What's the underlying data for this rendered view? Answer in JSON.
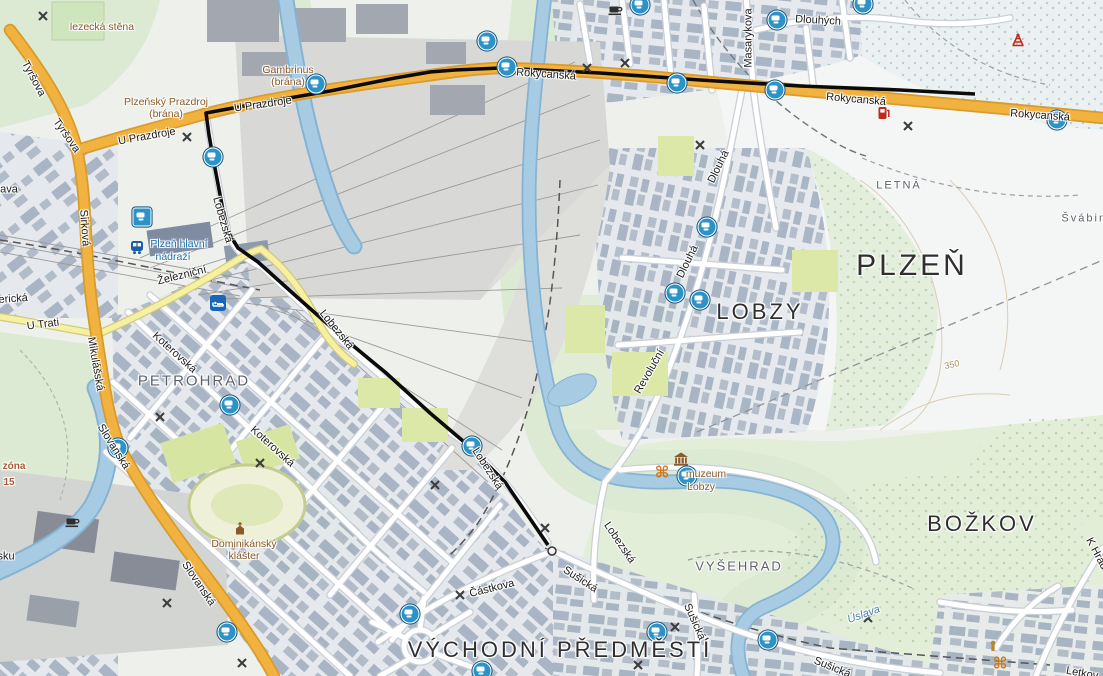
{
  "map": {
    "route": {
      "color": "#0b0b0b",
      "points": [
        [
          975,
          94
        ],
        [
          900,
          90
        ],
        [
          800,
          86
        ],
        [
          700,
          80
        ],
        [
          600,
          73
        ],
        [
          540,
          70
        ],
        [
          500,
          68
        ],
        [
          455,
          70
        ],
        [
          430,
          72
        ],
        [
          395,
          78
        ],
        [
          330,
          91
        ],
        [
          260,
          103
        ],
        [
          206,
          113
        ],
        [
          209,
          135
        ],
        [
          214,
          163
        ],
        [
          222,
          205
        ],
        [
          228,
          232
        ],
        [
          238,
          248
        ],
        [
          258,
          262
        ],
        [
          297,
          297
        ],
        [
          340,
          335
        ],
        [
          385,
          372
        ],
        [
          430,
          413
        ],
        [
          470,
          447
        ],
        [
          505,
          482
        ],
        [
          548,
          545
        ]
      ],
      "end_dot": [
        552,
        551
      ]
    },
    "labels": [
      {
        "text": "PLZEŇ",
        "x": 912,
        "y": 266,
        "r": 0,
        "c": "d1",
        "s": 30
      },
      {
        "text": "LOBZY",
        "x": 760,
        "y": 312,
        "r": 0,
        "c": "d1",
        "s": 22
      },
      {
        "text": "BOŽKOV",
        "x": 982,
        "y": 524,
        "r": 0,
        "c": "d1",
        "s": 22
      },
      {
        "text": "VÝCHODNÍ PŘEDMĚSTÍ",
        "x": 560,
        "y": 650,
        "r": 0,
        "c": "d1",
        "s": 22
      },
      {
        "text": "PETROHRAD",
        "x": 194,
        "y": 381,
        "r": 0,
        "c": "d2",
        "s": 15
      },
      {
        "text": "VYŠEHRAD",
        "x": 739,
        "y": 566,
        "r": 0,
        "c": "d2",
        "s": 13
      },
      {
        "text": "LETNÁ",
        "x": 899,
        "y": 186,
        "r": 0,
        "c": "d2",
        "s": 11
      },
      {
        "text": "Švábiny",
        "x": 1088,
        "y": 219,
        "r": 0,
        "c": "d2",
        "s": 11
      },
      {
        "text": "Tyršova",
        "x": 33,
        "y": 79,
        "r": 62,
        "c": "st"
      },
      {
        "text": "Tyršova",
        "x": 66,
        "y": 136,
        "r": 55,
        "c": "st"
      },
      {
        "text": "Sirková",
        "x": 84,
        "y": 228,
        "r": 86,
        "c": "st"
      },
      {
        "text": "U Prazdroje",
        "x": 263,
        "y": 105,
        "r": -8,
        "c": "st"
      },
      {
        "text": "U Prazdroje",
        "x": 147,
        "y": 137,
        "r": -10,
        "c": "st"
      },
      {
        "text": "Rokycanská",
        "x": 546,
        "y": 75,
        "r": 4,
        "c": "st"
      },
      {
        "text": "Rokycanská",
        "x": 856,
        "y": 100,
        "r": 5,
        "c": "st"
      },
      {
        "text": "Rokycanská",
        "x": 1040,
        "y": 116,
        "r": 4,
        "c": "st"
      },
      {
        "text": "Masarykova",
        "x": 749,
        "y": 38,
        "r": -90,
        "c": "st"
      },
      {
        "text": "Dlouhých",
        "x": 818,
        "y": 21,
        "r": 3,
        "c": "st"
      },
      {
        "text": "Dlouhá",
        "x": 719,
        "y": 167,
        "r": -64,
        "c": "st"
      },
      {
        "text": "Dlouhá",
        "x": 688,
        "y": 262,
        "r": -64,
        "c": "st"
      },
      {
        "text": "Revoluční",
        "x": 650,
        "y": 372,
        "r": -60,
        "c": "st"
      },
      {
        "text": "Lobezská",
        "x": 222,
        "y": 220,
        "r": 74,
        "c": "st"
      },
      {
        "text": "Lobezská",
        "x": 336,
        "y": 330,
        "r": 51,
        "c": "st"
      },
      {
        "text": "Lobezská",
        "x": 487,
        "y": 469,
        "r": 57,
        "c": "st"
      },
      {
        "text": "Lobezská",
        "x": 619,
        "y": 543,
        "r": 56,
        "c": "st"
      },
      {
        "text": "Železniční",
        "x": 182,
        "y": 276,
        "r": -14,
        "c": "st"
      },
      {
        "text": "U Trati",
        "x": 43,
        "y": 325,
        "r": -7,
        "c": "st"
      },
      {
        "text": "Mikulášská",
        "x": 95,
        "y": 364,
        "r": 80,
        "c": "st"
      },
      {
        "text": "Koterovská",
        "x": 174,
        "y": 353,
        "r": 42,
        "c": "st"
      },
      {
        "text": "Koterovská",
        "x": 272,
        "y": 447,
        "r": 42,
        "c": "st"
      },
      {
        "text": "Slovanská",
        "x": 113,
        "y": 447,
        "r": 58,
        "c": "st"
      },
      {
        "text": "Slovanská",
        "x": 198,
        "y": 584,
        "r": 56,
        "c": "st"
      },
      {
        "text": "Sušická",
        "x": 580,
        "y": 580,
        "r": 33,
        "c": "st"
      },
      {
        "text": "Sušická",
        "x": 694,
        "y": 622,
        "r": 66,
        "c": "st"
      },
      {
        "text": "Sušická",
        "x": 832,
        "y": 668,
        "r": 22,
        "c": "st"
      },
      {
        "text": "Částkova",
        "x": 492,
        "y": 589,
        "r": -14,
        "c": "st"
      },
      {
        "text": "K Hrádku",
        "x": 1099,
        "y": 559,
        "r": 62,
        "c": "st"
      },
      {
        "text": "Letkov",
        "x": 1082,
        "y": 674,
        "r": 10,
        "c": "st"
      },
      {
        "text": "Americká",
        "x": 5,
        "y": 300,
        "r": -4,
        "c": "st"
      },
      {
        "text": "ava",
        "x": 9,
        "y": 190,
        "r": 0,
        "c": "st"
      },
      {
        "text": "sku",
        "x": 6,
        "y": 557,
        "r": 0,
        "c": "st"
      },
      {
        "text": "lezecká stěna",
        "x": 102,
        "y": 27,
        "r": 0,
        "c": "poi"
      },
      {
        "text": "Gambrinus",
        "x": 288,
        "y": 70,
        "r": 0,
        "c": "poi"
      },
      {
        "text": "(brána)",
        "x": 288,
        "y": 82,
        "r": 0,
        "c": "poi"
      },
      {
        "text": "Plzeňský Prazdroj",
        "x": 166,
        "y": 102,
        "r": 0,
        "c": "poi"
      },
      {
        "text": "(brána)",
        "x": 166,
        "y": 114,
        "r": 0,
        "c": "poi"
      },
      {
        "text": "Dominikánský",
        "x": 244,
        "y": 544,
        "r": 0,
        "c": "poi"
      },
      {
        "text": "klášter",
        "x": 244,
        "y": 556,
        "r": 0,
        "c": "poi"
      },
      {
        "text": "muzeum",
        "x": 706,
        "y": 474,
        "r": 0,
        "c": "poi"
      },
      {
        "text": "Lobzy",
        "x": 701,
        "y": 487,
        "r": 0,
        "c": "poi"
      },
      {
        "text": "Plzeň hlavní",
        "x": 179,
        "y": 244,
        "r": 0,
        "c": "sta"
      },
      {
        "text": "nádraží",
        "x": 173,
        "y": 257,
        "r": 0,
        "c": "sta"
      },
      {
        "text": "Úslava",
        "x": 864,
        "y": 615,
        "r": -20,
        "c": "wat"
      },
      {
        "text": "zóna",
        "x": 14,
        "y": 467,
        "r": 0,
        "c": "zon"
      },
      {
        "text": "15",
        "x": 9,
        "y": 483,
        "r": 0,
        "c": "zon"
      },
      {
        "text": "350",
        "x": 952,
        "y": 365,
        "r": -12,
        "c": "con"
      }
    ],
    "tram_stops": [
      [
        487,
        41
      ],
      [
        640,
        5
      ],
      [
        316,
        84
      ],
      [
        507,
        67
      ],
      [
        677,
        83
      ],
      [
        777,
        20
      ],
      [
        863,
        4
      ],
      [
        775,
        90
      ],
      [
        1057,
        120
      ],
      [
        213,
        157
      ],
      [
        230,
        405
      ],
      [
        118,
        448
      ],
      [
        472,
        446
      ],
      [
        707,
        227
      ],
      [
        675,
        293
      ],
      [
        700,
        300
      ],
      [
        410,
        614
      ],
      [
        657,
        632
      ],
      [
        482,
        671
      ],
      [
        687,
        476
      ],
      [
        768,
        640
      ],
      [
        227,
        632
      ]
    ],
    "square_stops": [
      [
        142,
        217
      ]
    ],
    "mill_icons": [
      [
        43,
        16
      ],
      [
        187,
        137
      ],
      [
        587,
        68
      ],
      [
        625,
        63
      ],
      [
        908,
        126
      ],
      [
        700,
        145
      ],
      [
        160,
        417
      ],
      [
        260,
        463
      ],
      [
        435,
        485
      ],
      [
        545,
        528
      ],
      [
        460,
        595
      ],
      [
        167,
        603
      ],
      [
        242,
        663
      ],
      [
        675,
        627
      ],
      [
        638,
        665
      ],
      [
        868,
        618
      ]
    ],
    "poi_icons": [
      {
        "type": "train-station",
        "x": 137,
        "y": 248
      },
      {
        "type": "hotel",
        "x": 218,
        "y": 303
      },
      {
        "type": "museum",
        "x": 681,
        "y": 459
      },
      {
        "type": "monument",
        "x": 662,
        "y": 473
      },
      {
        "type": "monument",
        "x": 1000,
        "y": 664
      },
      {
        "type": "church",
        "x": 240,
        "y": 529
      },
      {
        "type": "coffee",
        "x": 616,
        "y": 11
      },
      {
        "type": "coffee",
        "x": 73,
        "y": 523
      },
      {
        "type": "fuel",
        "x": 884,
        "y": 113
      },
      {
        "type": "tower",
        "x": 1018,
        "y": 40
      },
      {
        "type": "shrine",
        "x": 993,
        "y": 646
      }
    ],
    "colors": {
      "route": "#0b0b0b",
      "major_road": "#f2b240",
      "minor_road": "#f5f0a2",
      "water": "#a8cbe4",
      "park": "#dcead3",
      "transit_blue": "#2b93c8",
      "poi_brown": "#8a5a28",
      "rail_gray": "#d8d9d6"
    }
  }
}
